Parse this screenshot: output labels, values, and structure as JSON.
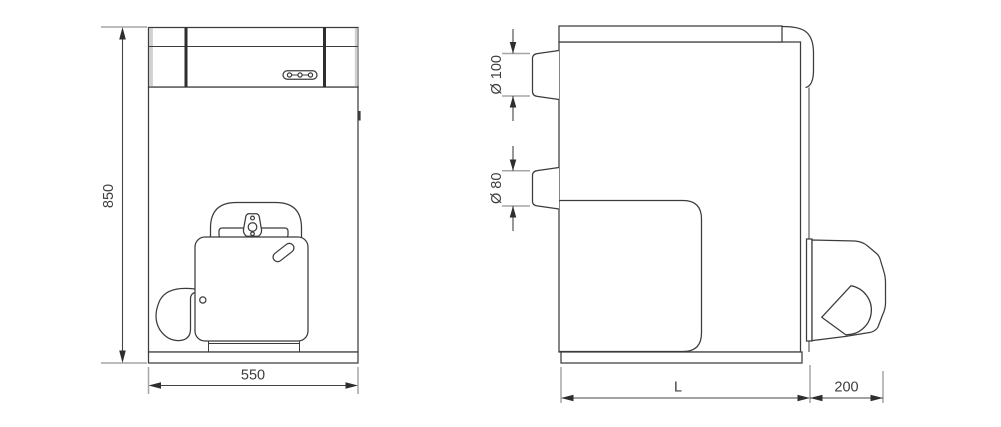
{
  "drawing": {
    "front_view": {
      "height_dim": "850",
      "width_dim": "550"
    },
    "side_view": {
      "flue_diameter_dim": "Ø 100",
      "pipe_diameter_dim": "Ø 80",
      "depth_dim": "L",
      "burner_projection_dim": "200"
    },
    "colors": {
      "line": "#3c3c3c",
      "extension_line": "#a6a6a6",
      "text": "#3d3d3d",
      "background": "#ffffff"
    }
  }
}
